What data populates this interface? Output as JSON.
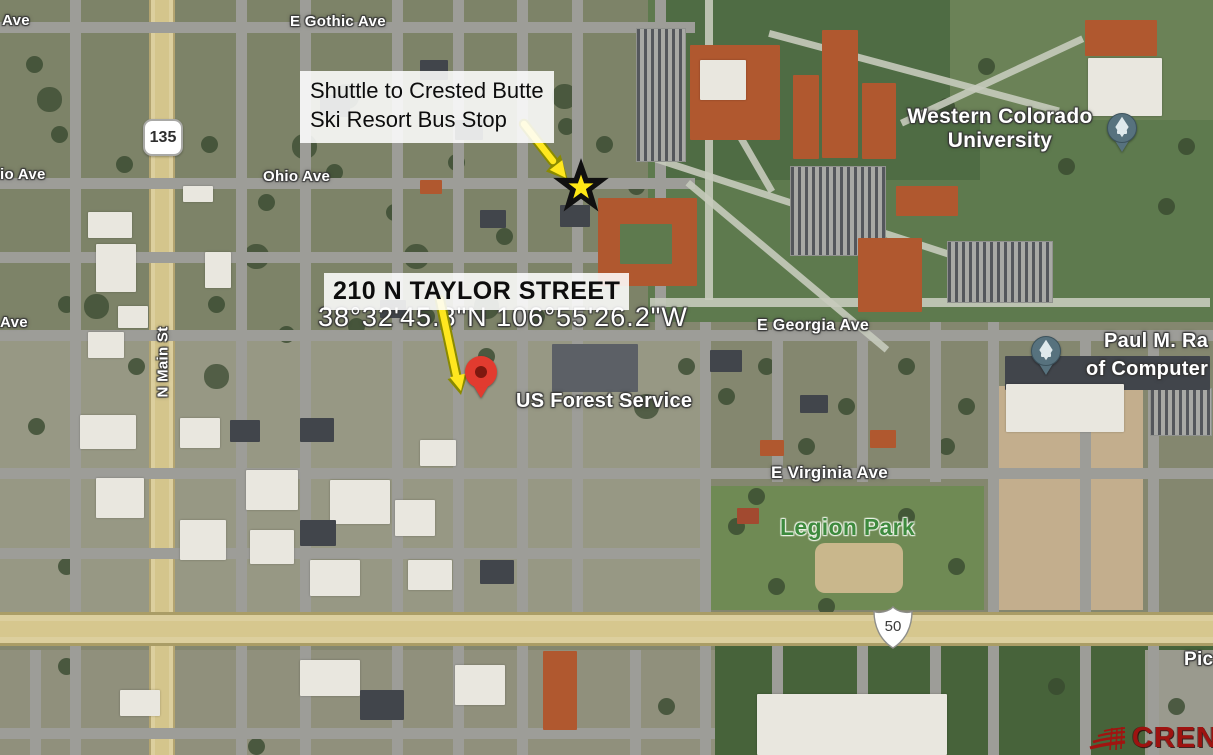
{
  "annotations": {
    "bus_stop": {
      "line1": "Shuttle to Crested Butte",
      "line2": "Ski Resort Bus Stop"
    },
    "address": {
      "title": "210 N TAYLOR STREET"
    },
    "coordinates": "38°32'45.8\"N 106°55'26.2\"W"
  },
  "street_labels": {
    "e_gothic_ave": "E Gothic Ave",
    "ohio_ave": "Ohio Ave",
    "ohio_ave_partial": "io Ave",
    "ave_partial_top": "Ave",
    "ave_partial_mid": "Ave",
    "n_main_st": "N Main St",
    "e_georgia_ave": "E Georgia Ave",
    "e_virginia_ave": "E Virginia Ave"
  },
  "place_labels": {
    "university_line1": "Western Colorado",
    "university_line2": "University",
    "forest_service": "US Forest Service",
    "legion_park": "Legion Park",
    "paul_m_line1": "Paul M. Ra",
    "paul_m_line2": "of Computer",
    "pic_partial": "Pic"
  },
  "route_shields": {
    "co_135": "135",
    "us_50": "50"
  },
  "watermark": "CREN",
  "colors": {
    "annotation_arrow": "#ffe71f",
    "star_yellow": "#ffe815",
    "pin_red": "#e23b2f",
    "education_pin_blue": "#57727e",
    "legion_park_green": "#3e8a3e",
    "cren_red": "#9e1310",
    "highway_tan": "#d4c58c"
  }
}
